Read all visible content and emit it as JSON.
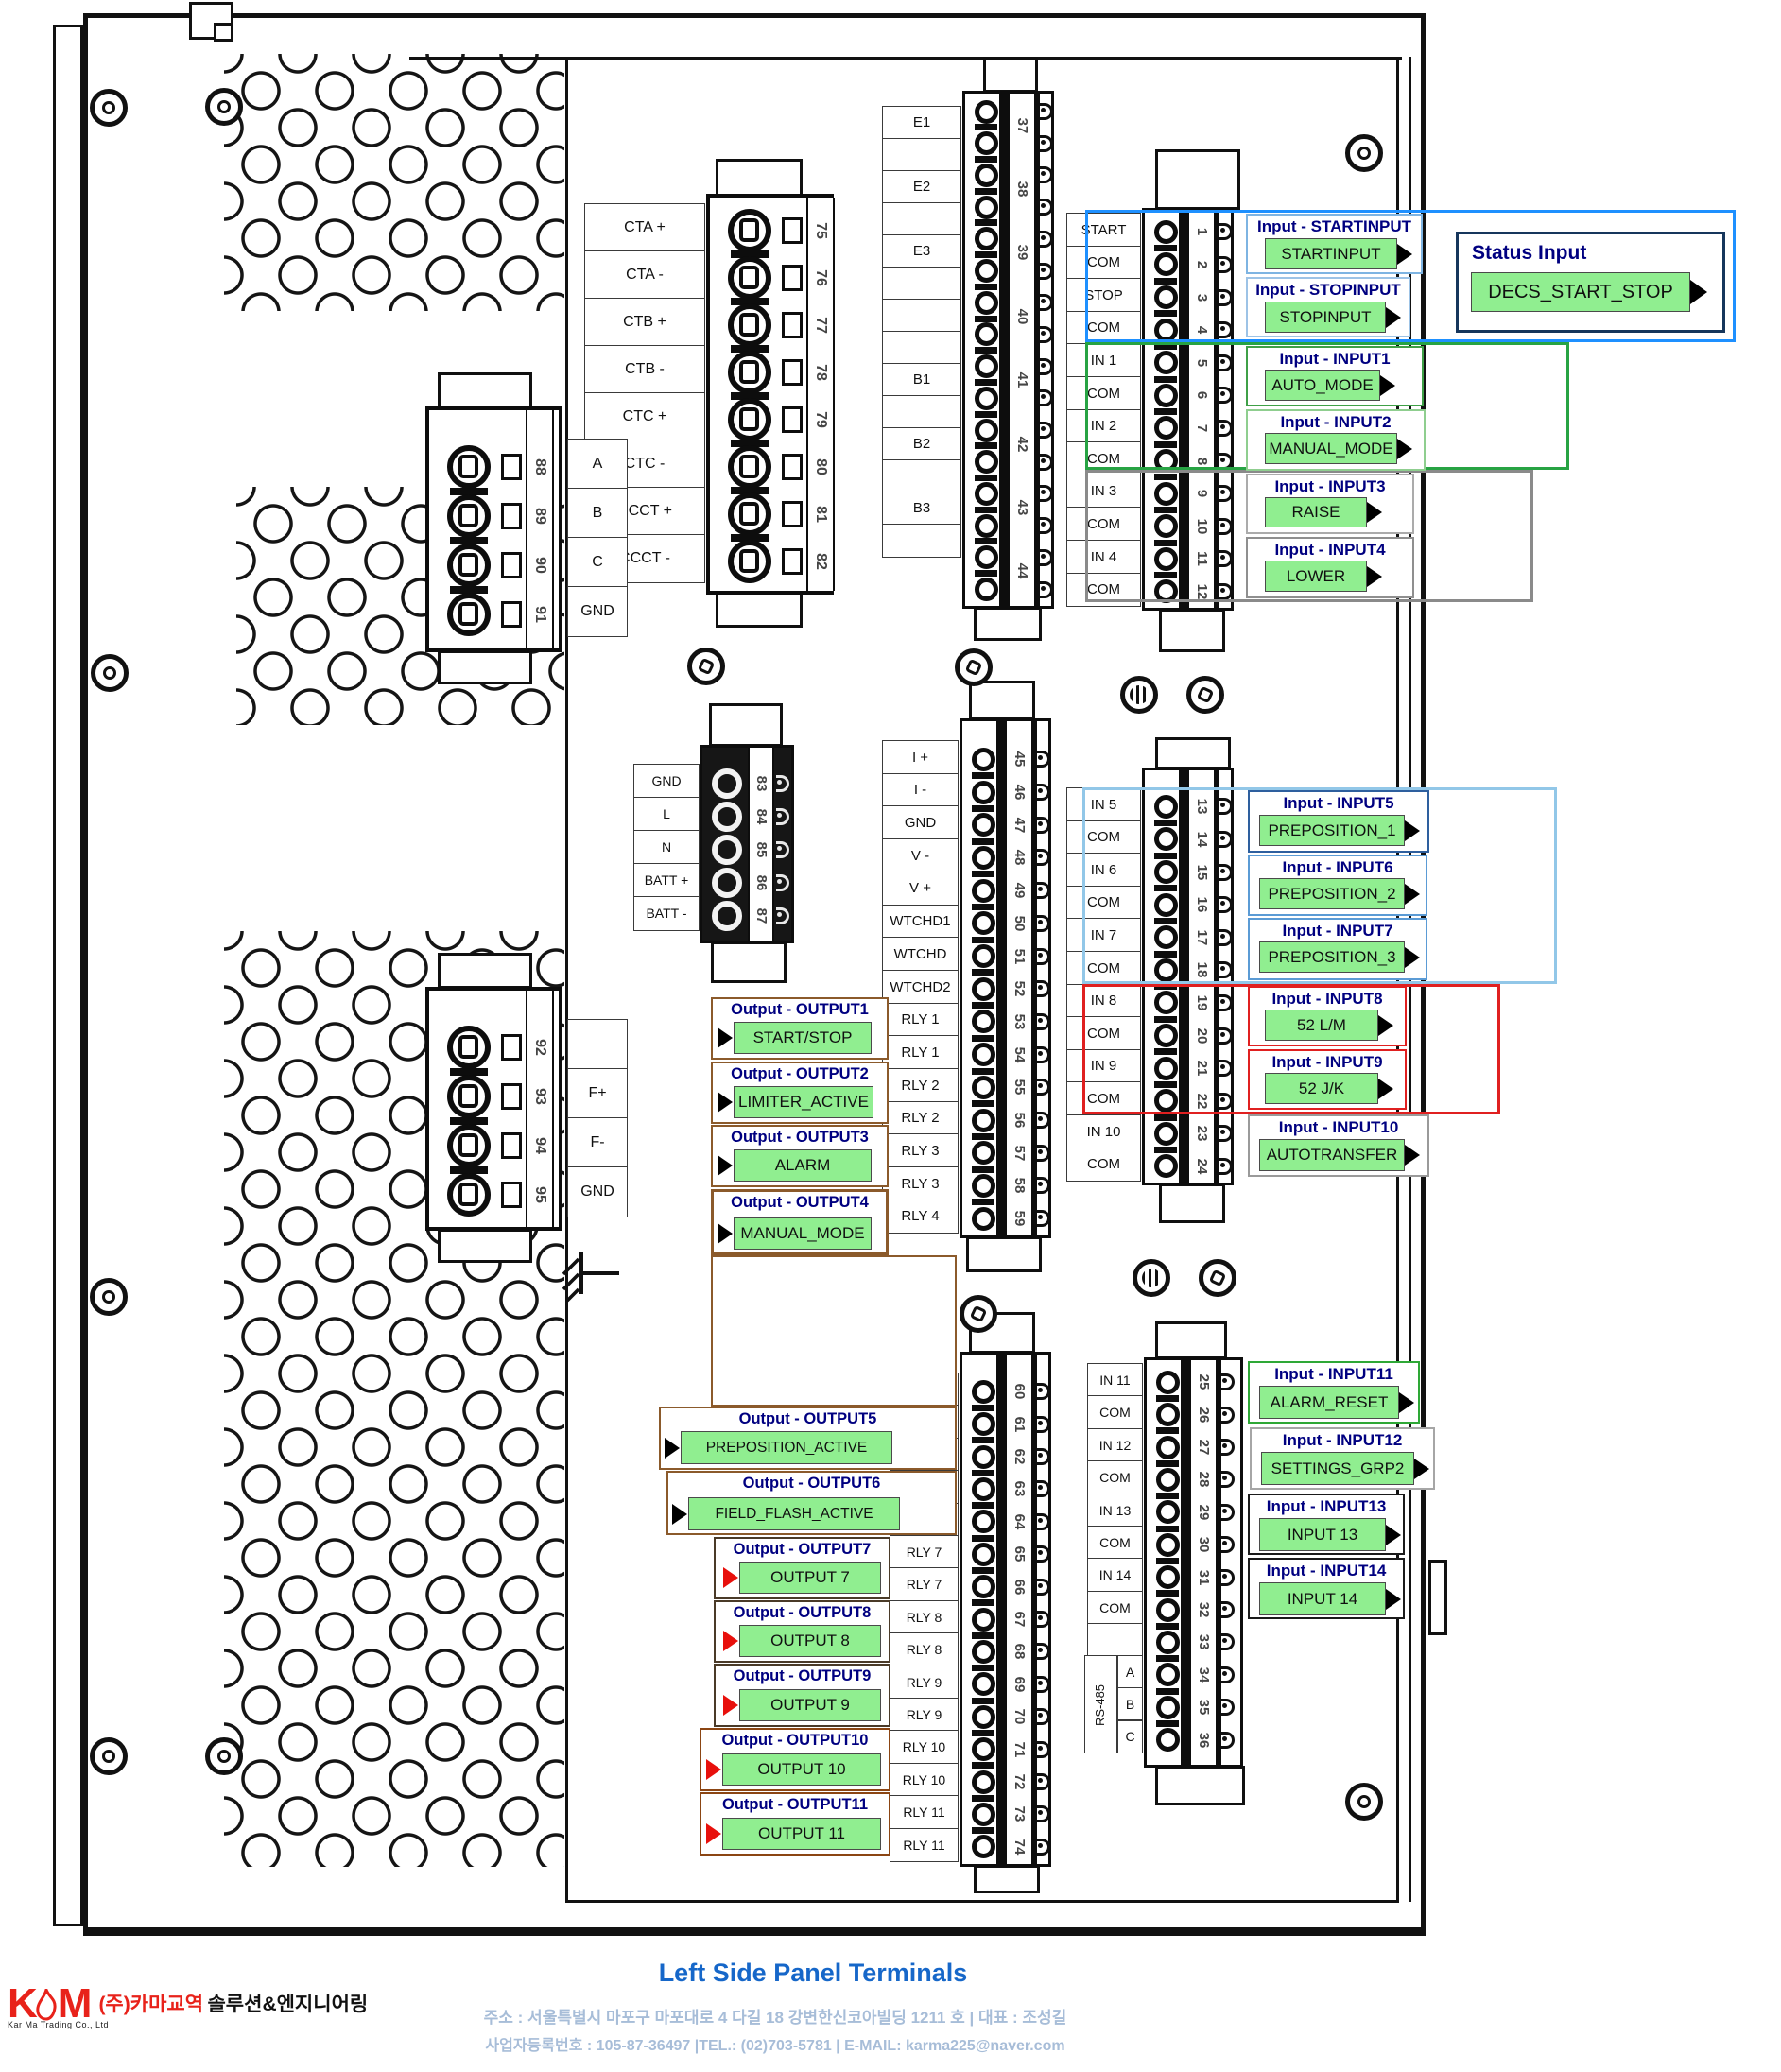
{
  "title": "Left Side Panel Terminals",
  "footer": {
    "address": "주소 : 서울특별시 마포구 마포대로 4 다길 18 강변한신코아빌딩 1211 호 | 대표 : 조성길",
    "registration": "사업자등록번호 : 105-87-36497 |TEL.: (02)703-5781 | E-MAIL: karma225@naver.com"
  },
  "logo": {
    "mark_left": "K",
    "mark_right": "M",
    "subtitle": "Kar Ma Trading Co., Ltd",
    "company_red": "(주)카마교역",
    "company_black": "솔루션&엔지니어링"
  },
  "colors": {
    "green_fill": "#90EE90",
    "header_navy": "#000080",
    "group_blue": "#1E90FF",
    "group_green": "#27A343",
    "group_gray": "#8A8A8A",
    "group_lightblue": "#92C7E8",
    "group_red": "#E02020",
    "annot_brown": "#8B5A2B",
    "arrow_red": "#E8100C",
    "title_blue": "#1667C9",
    "footer_blue": "#A7BDD8",
    "logo_red": "#E8221A"
  },
  "status_input": {
    "header": "Status Input",
    "value": "DECS_START_STOP"
  },
  "rs485": {
    "label": "RS-485",
    "pins": [
      "A",
      "B",
      "C"
    ]
  },
  "blocks": {
    "ct": {
      "labels": [
        "CTA +",
        "CTA -",
        "CTB +",
        "CTB -",
        "CTC +",
        "CTC -",
        "CCCT +",
        "CCCT -"
      ],
      "numbers": [
        "75",
        "76",
        "77",
        "78",
        "79",
        "80",
        "81",
        "82"
      ]
    },
    "abc": {
      "labels": [
        "A",
        "B",
        "C",
        "GND"
      ],
      "numbers": [
        "88",
        "89",
        "90",
        "91"
      ]
    },
    "f": {
      "labels": [
        "",
        "F+",
        "F-",
        "GND"
      ],
      "numbers": [
        "92",
        "93",
        "94",
        "95"
      ]
    },
    "pwr": {
      "labels": [
        "GND",
        "L",
        "N",
        "BATT +",
        "BATT -"
      ],
      "numbers": [
        "83",
        "84",
        "85",
        "86",
        "87"
      ]
    },
    "e": {
      "labels": [
        "E1",
        "",
        "E2",
        "",
        "E3",
        "",
        "",
        "",
        "B1",
        "",
        "B2",
        "",
        "B3",
        ""
      ],
      "numbers": [
        "37",
        "38",
        "39",
        "40",
        "41",
        "42",
        "43",
        "44"
      ]
    },
    "dia": {
      "labels": [
        "START",
        "COM",
        "STOP",
        "COM",
        "IN 1",
        "COM",
        "IN 2",
        "COM",
        "IN 3",
        "COM",
        "IN 4",
        "COM"
      ],
      "numbers": [
        "1",
        "2",
        "3",
        "4",
        "5",
        "6",
        "7",
        "8",
        "9",
        "10",
        "11",
        "12"
      ]
    },
    "ai": {
      "labels": [
        "I +",
        "I -",
        "GND",
        "V -",
        "V +",
        "WTCHD1",
        "WTCHD",
        "WTCHD2",
        "RLY 1",
        "RLY 1",
        "RLY 2",
        "RLY 2",
        "RLY 3",
        "RLY 3",
        "RLY 4"
      ],
      "numbers": [
        "45",
        "46",
        "47",
        "48",
        "49",
        "50",
        "51",
        "52",
        "53",
        "54",
        "55",
        "56",
        "57",
        "58",
        "59"
      ]
    },
    "dib": {
      "labels": [
        "IN 5",
        "COM",
        "IN 6",
        "COM",
        "IN 7",
        "COM",
        "IN 8",
        "COM",
        "IN 9",
        "COM",
        "IN 10",
        "COM"
      ],
      "numbers": [
        "13",
        "14",
        "15",
        "16",
        "17",
        "18",
        "19",
        "20",
        "21",
        "22",
        "23",
        "24"
      ]
    },
    "rly": {
      "labels": [
        "RLY 4",
        "RLY 5",
        "RLY 5",
        "RLY 6",
        "RLY 6",
        "RLY 7",
        "RLY 7",
        "RLY 8",
        "RLY 8",
        "RLY 9",
        "RLY 9",
        "RLY 10",
        "RLY 10",
        "RLY 11",
        "RLY 11"
      ],
      "numbers": [
        "60",
        "61",
        "62",
        "63",
        "64",
        "65",
        "66",
        "67",
        "68",
        "69",
        "70",
        "71",
        "72",
        "73",
        "74"
      ]
    },
    "dic": {
      "labels": [
        "IN 11",
        "COM",
        "IN 12",
        "COM",
        "IN 13",
        "COM",
        "IN 14",
        "COM",
        ""
      ],
      "numbers": [
        "25",
        "26",
        "27",
        "28",
        "29",
        "30",
        "31",
        "32",
        "33",
        "34",
        "35",
        "36"
      ]
    }
  },
  "inputs": [
    {
      "id": "input-startinput",
      "header": "Input - STARTINPUT",
      "value": "STARTINPUT"
    },
    {
      "id": "input-stopinput",
      "header": "Input - STOPINPUT",
      "value": "STOPINPUT"
    },
    {
      "id": "input-1",
      "header": "Input - INPUT1",
      "value": "AUTO_MODE"
    },
    {
      "id": "input-2",
      "header": "Input - INPUT2",
      "value": "MANUAL_MODE"
    },
    {
      "id": "input-3",
      "header": "Input - INPUT3",
      "value": "RAISE"
    },
    {
      "id": "input-4",
      "header": "Input - INPUT4",
      "value": "LOWER"
    },
    {
      "id": "input-5",
      "header": "Input - INPUT5",
      "value": "PREPOSITION_1"
    },
    {
      "id": "input-6",
      "header": "Input - INPUT6",
      "value": "PREPOSITION_2"
    },
    {
      "id": "input-7",
      "header": "Input - INPUT7",
      "value": "PREPOSITION_3"
    },
    {
      "id": "input-8",
      "header": "Input - INPUT8",
      "value": "52 L/M"
    },
    {
      "id": "input-9",
      "header": "Input - INPUT9",
      "value": "52 J/K"
    },
    {
      "id": "input-10",
      "header": "Input - INPUT10",
      "value": "AUTOTRANSFER"
    },
    {
      "id": "input-11",
      "header": "Input - INPUT11",
      "value": "ALARM_RESET"
    },
    {
      "id": "input-12",
      "header": "Input - INPUT12",
      "value": "SETTINGS_GRP2"
    },
    {
      "id": "input-13",
      "header": "Input - INPUT13",
      "value": "INPUT 13"
    },
    {
      "id": "input-14",
      "header": "Input - INPUT14",
      "value": "INPUT 14"
    }
  ],
  "outputs": [
    {
      "id": "output-1",
      "header": "Output - OUTPUT1",
      "value": "START/STOP"
    },
    {
      "id": "output-2",
      "header": "Output - OUTPUT2",
      "value": "LIMITER_ACTIVE"
    },
    {
      "id": "output-3",
      "header": "Output - OUTPUT3",
      "value": "ALARM"
    },
    {
      "id": "output-4",
      "header": "Output - OUTPUT4",
      "value": "MANUAL_MODE"
    },
    {
      "id": "output-5",
      "header": "Output - OUTPUT5",
      "value": "PREPOSITION_ACTIVE"
    },
    {
      "id": "output-6",
      "header": "Output - OUTPUT6",
      "value": "FIELD_FLASH_ACTIVE"
    },
    {
      "id": "output-7",
      "header": "Output - OUTPUT7",
      "value": "OUTPUT 7"
    },
    {
      "id": "output-8",
      "header": "Output - OUTPUT8",
      "value": "OUTPUT 8"
    },
    {
      "id": "output-9",
      "header": "Output - OUTPUT9",
      "value": "OUTPUT 9"
    },
    {
      "id": "output-10",
      "header": "Output - OUTPUT10",
      "value": "OUTPUT 10"
    },
    {
      "id": "output-11",
      "header": "Output - OUTPUT11",
      "value": "OUTPUT 11"
    }
  ]
}
